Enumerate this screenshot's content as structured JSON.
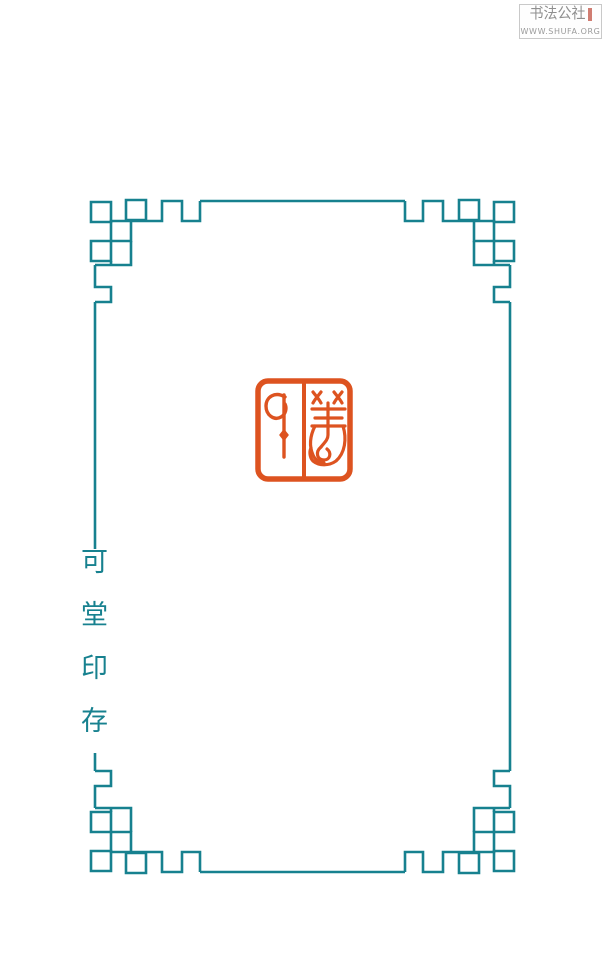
{
  "page": {
    "background": "#ffffff",
    "width": 605,
    "height": 964
  },
  "frame": {
    "style": "chinese-fretwork-border",
    "color": "#17818f"
  },
  "left_title": {
    "text": "可堂印存",
    "chars": [
      "可",
      "堂",
      "印",
      "存"
    ],
    "color": "#17818f"
  },
  "seal": {
    "character": "儀",
    "script": "seal-script",
    "color": "#dd5320"
  },
  "watermark": {
    "site_name": "书法公社",
    "url": "WWW.SHUFA.ORG",
    "text_color": "#8f8f8f",
    "border_color": "#c9c9c9",
    "seal_mark_color": "#c05243"
  }
}
